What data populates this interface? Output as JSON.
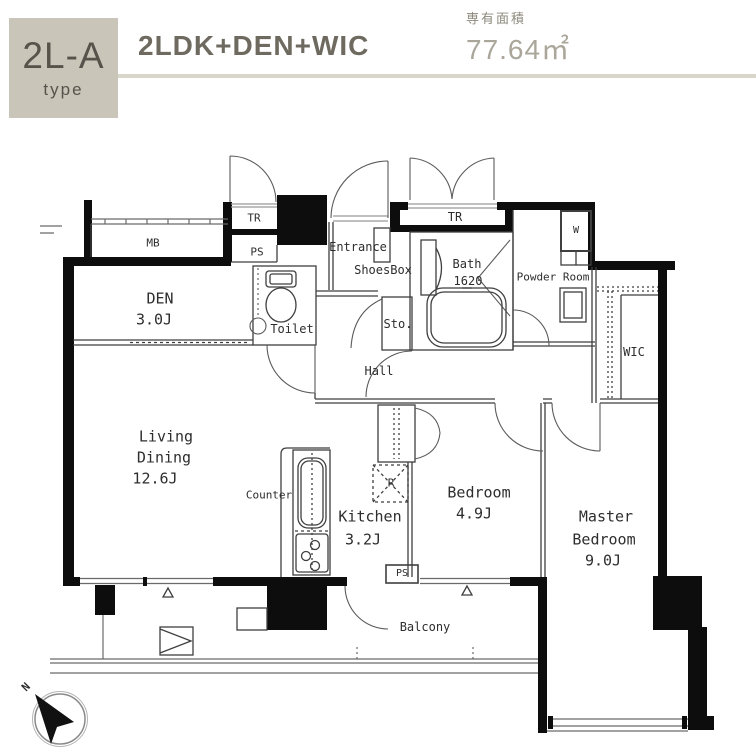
{
  "header": {
    "type_code": "2L-A",
    "type_label": "type",
    "plan_name": "2LDK+DEN+WIC",
    "area_caption": "専有面積",
    "area_value": "77.64㎡"
  },
  "plan": {
    "mb": "MB",
    "tr_left": "TR",
    "ps_left": "PS",
    "tr_right": "TR",
    "entrance": "Entrance",
    "shoesbox": "ShoesBox",
    "toilet": "Toilet",
    "sto": "Sto.",
    "hall": "Hall",
    "bath_line1": "Bath",
    "bath_line2": "1620",
    "powder_room": "Powder Room",
    "washer": "W",
    "wic": "WIC",
    "den_line1": "DEN",
    "den_line2": "3.0J",
    "living_line1": "Living",
    "living_line2": "Dining",
    "living_line3": "12.6J",
    "counter": "Counter",
    "kitchen_line1": "Kitchen",
    "kitchen_line2": "3.2J",
    "fridge": "R",
    "bedroom_line1": "Bedroom",
    "bedroom_line2": "4.9J",
    "master_line1": "Master",
    "master_line2": "Bedroom",
    "master_line3": "9.0J",
    "ps_bottom": "PS",
    "balcony": "Balcony",
    "compass_north": "N"
  },
  "colors": {
    "badge_bg": "#c9c5b9",
    "badge_text": "#57534b",
    "title_text": "#6e6a60",
    "caption_text": "#8d897c",
    "area_text": "#aaa69a",
    "divider": "#d9d6cc",
    "line": "#3f3f3f",
    "wall": "#0d0d0d"
  }
}
